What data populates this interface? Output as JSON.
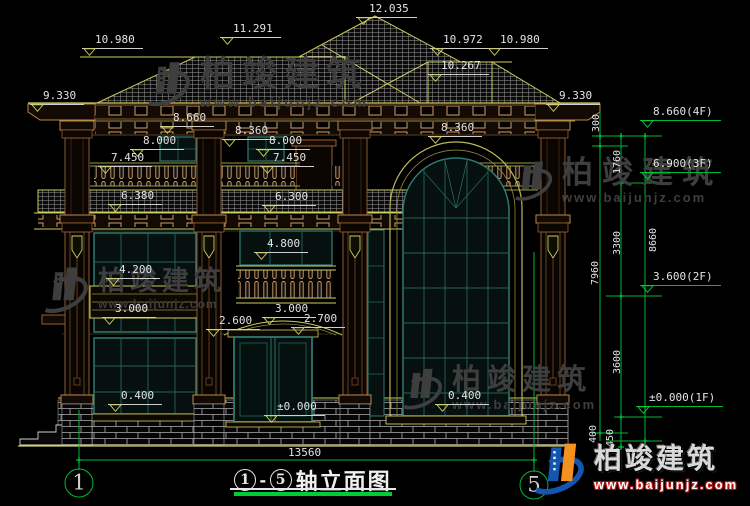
{
  "page": {
    "width": 750,
    "height": 506
  },
  "colors": {
    "background": "#000000",
    "cad_yellow": "#cdcd5e",
    "cad_teal": "#2e7a70",
    "cad_brown": "#9a5c30",
    "dim_text": "#e3e3e3",
    "dim_green": "#00b835",
    "watermark_gray": "#3e3e3e",
    "logo_blue": "#1256b0",
    "logo_orange": "#f59120",
    "logo_red": "#cc2222"
  },
  "title": {
    "axis_start": "1",
    "dash": "-",
    "axis_end": "5",
    "label": "轴立面图"
  },
  "overall_dim": "13560",
  "axes": [
    {
      "n": "1"
    },
    {
      "n": "5"
    }
  ],
  "levels": [
    {
      "t": "12.035",
      "x": 356,
      "y": 3
    },
    {
      "t": "10.980",
      "x": 82,
      "y": 34
    },
    {
      "t": "11.291",
      "x": 220,
      "y": 23
    },
    {
      "t": "10.972",
      "x": 430,
      "y": 34
    },
    {
      "t": "10.980",
      "x": 487,
      "y": 34
    },
    {
      "t": "10.267",
      "x": 428,
      "y": 60
    },
    {
      "t": "9.330",
      "x": 30,
      "y": 90
    },
    {
      "t": "9.330",
      "x": 546,
      "y": 90
    },
    {
      "t": "8.660",
      "x": 160,
      "y": 112
    },
    {
      "t": "8.360",
      "x": 222,
      "y": 125
    },
    {
      "t": "8.360",
      "x": 428,
      "y": 122
    },
    {
      "t": "8.000",
      "x": 130,
      "y": 135
    },
    {
      "t": "8.000",
      "x": 256,
      "y": 135
    },
    {
      "t": "7.450",
      "x": 98,
      "y": 152
    },
    {
      "t": "7.450",
      "x": 260,
      "y": 152
    },
    {
      "t": "6.380",
      "x": 108,
      "y": 190
    },
    {
      "t": "6.300",
      "x": 262,
      "y": 191
    },
    {
      "t": "4.800",
      "x": 254,
      "y": 238
    },
    {
      "t": "4.200",
      "x": 106,
      "y": 264
    },
    {
      "t": "3.000",
      "x": 102,
      "y": 303
    },
    {
      "t": "3.000",
      "x": 262,
      "y": 303
    },
    {
      "t": "2.600",
      "x": 206,
      "y": 315
    },
    {
      "t": "2.700",
      "x": 291,
      "y": 313
    },
    {
      "t": "0.400",
      "x": 108,
      "y": 390
    },
    {
      "t": "0.400",
      "x": 435,
      "y": 390
    },
    {
      "t": "±0.000",
      "x": 264,
      "y": 401
    }
  ],
  "levels_right": [
    {
      "t": "8.660(4F)",
      "x": 640,
      "y": 106
    },
    {
      "t": "6.900(3F)",
      "x": 640,
      "y": 158
    },
    {
      "t": "3.600(2F)",
      "x": 640,
      "y": 271
    },
    {
      "t": "±0.000(1F)",
      "x": 636,
      "y": 392
    }
  ],
  "vdims": [
    {
      "t": "300",
      "x": 597,
      "y": 123
    },
    {
      "t": "1760",
      "x": 618,
      "y": 162
    },
    {
      "t": "3300",
      "x": 618,
      "y": 243
    },
    {
      "t": "7960",
      "x": 596,
      "y": 273
    },
    {
      "t": "8660",
      "x": 654,
      "y": 240
    },
    {
      "t": "3600",
      "x": 618,
      "y": 362
    },
    {
      "t": "400",
      "x": 594,
      "y": 434
    },
    {
      "t": "450",
      "x": 611,
      "y": 438
    }
  ],
  "watermark": {
    "brand": "柏竣建筑",
    "site": "www.baijunjz.com"
  },
  "logo": {
    "brand": "柏竣建筑",
    "site": "www.baijunjz.com"
  }
}
